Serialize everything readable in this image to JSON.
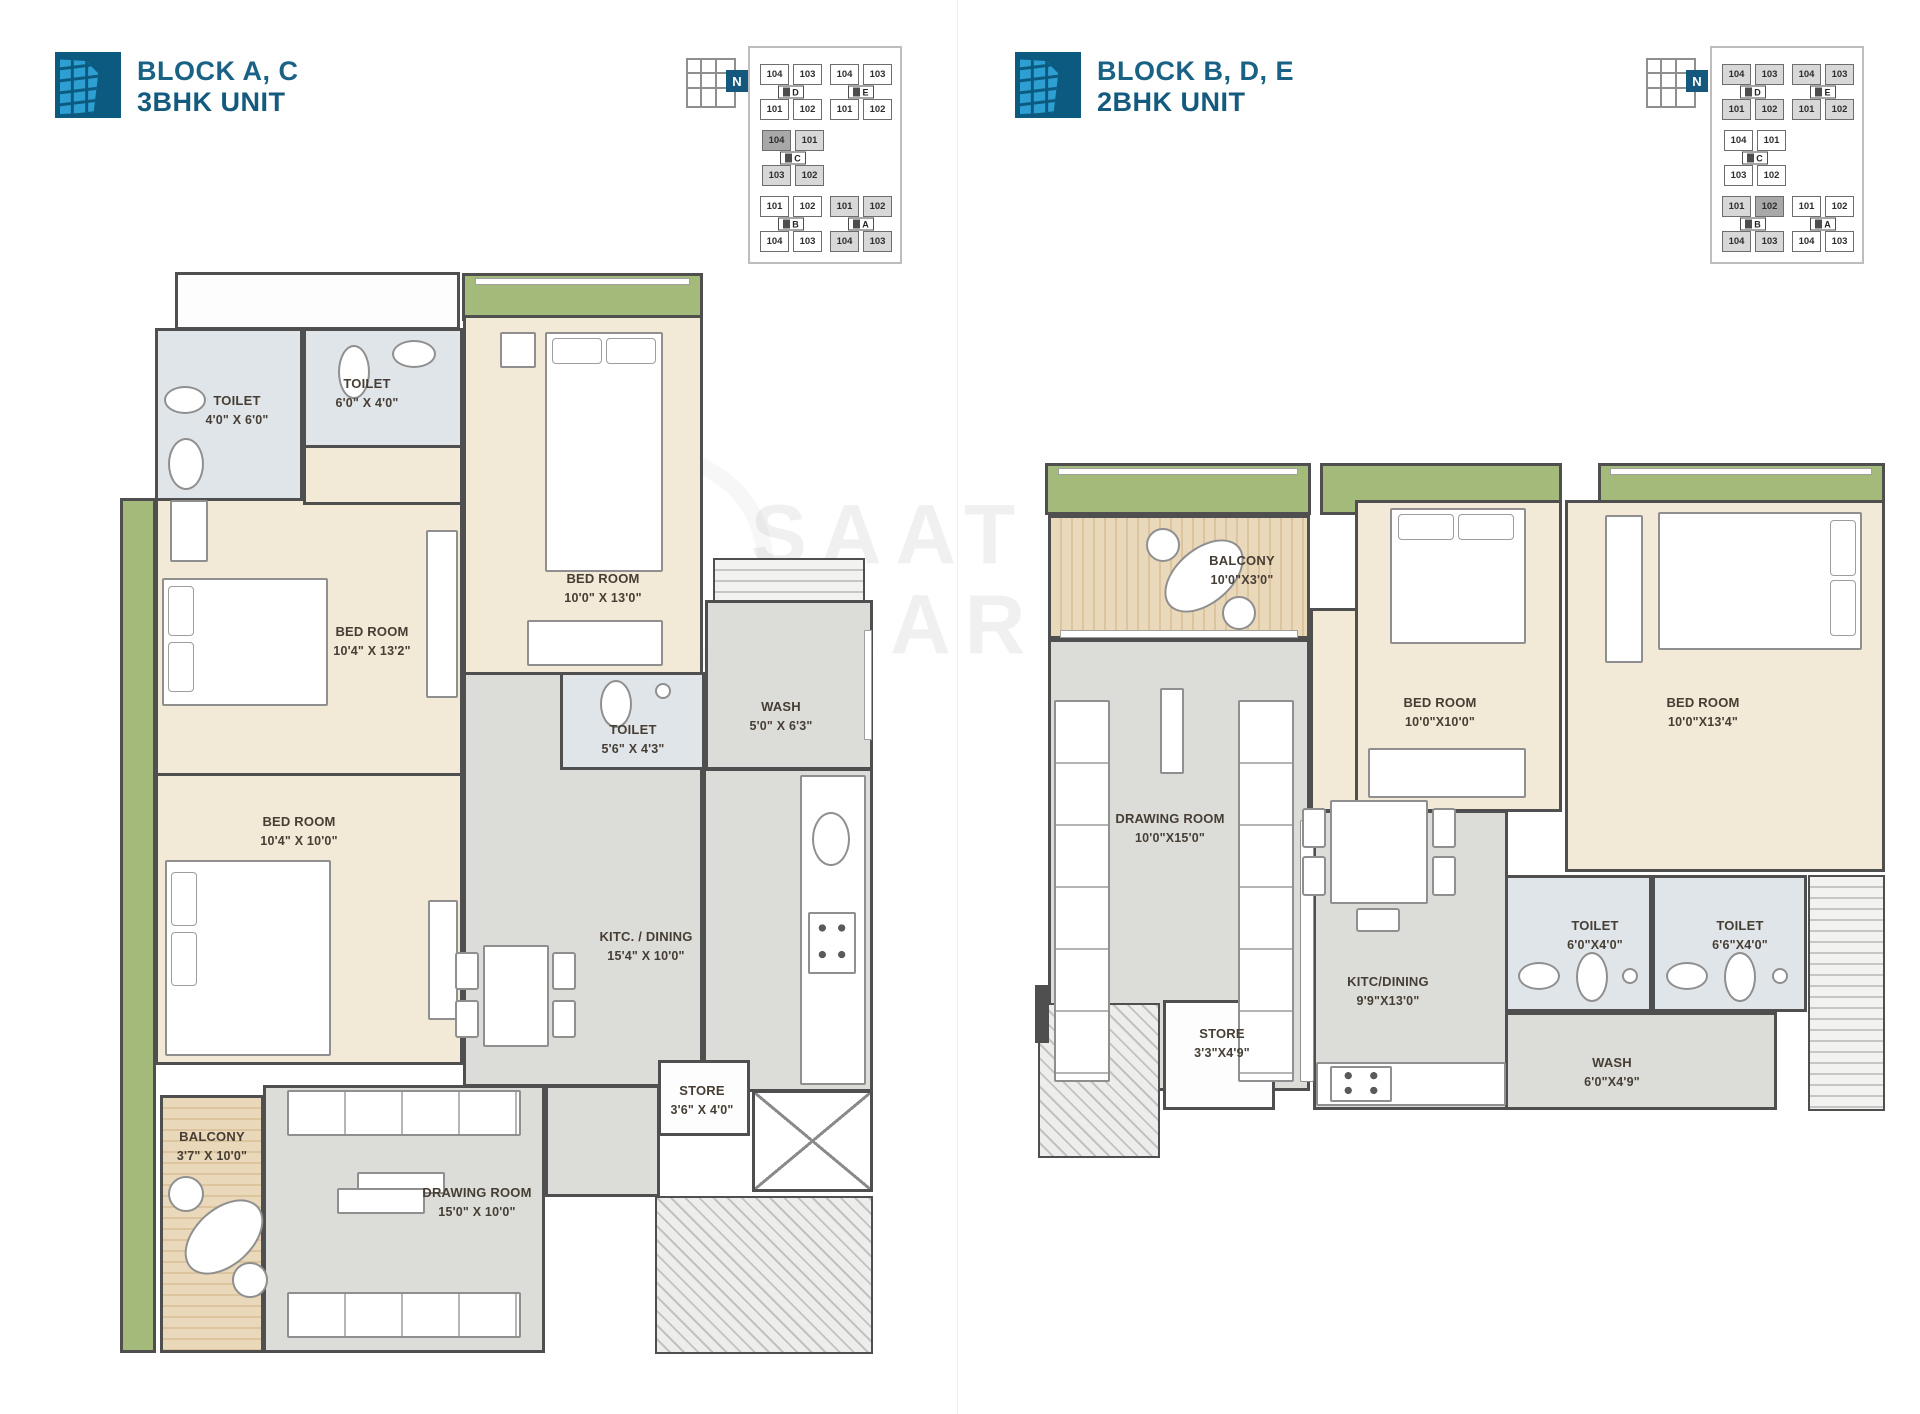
{
  "panels": {
    "left": {
      "block_title": "BLOCK A, C",
      "unit_title": "3BHK UNIT",
      "north": "N",
      "keyplan": {
        "highlighted_blocks": [
          "A",
          "C"
        ],
        "blocks": [
          {
            "letter": "D",
            "units": [
              "104",
              "103",
              "101",
              "102"
            ]
          },
          {
            "letter": "E",
            "units": [
              "104",
              "103",
              "101",
              "102"
            ]
          },
          {
            "letter": "C",
            "units": [
              "104",
              "101",
              "103",
              "102"
            ]
          },
          {
            "letter": "B",
            "units": [
              "101",
              "102",
              "104",
              "103"
            ]
          },
          {
            "letter": "A",
            "units": [
              "101",
              "102",
              "104",
              "103"
            ]
          }
        ]
      },
      "rooms": {
        "toilet1": {
          "name": "TOILET",
          "dim": "4'0\" X 6'0\""
        },
        "toilet2": {
          "name": "TOILET",
          "dim": "6'0\" X 4'0\""
        },
        "bedroom1": {
          "name": "BED ROOM",
          "dim": "10'0\" X 13'0\""
        },
        "bedroom2": {
          "name": "BED ROOM",
          "dim": "10'4\" X 13'2\""
        },
        "toilet3": {
          "name": "TOILET",
          "dim": "5'6\" X 4'3\""
        },
        "wash": {
          "name": "WASH",
          "dim": "5'0\" X 6'3\""
        },
        "bedroom3": {
          "name": "BED ROOM",
          "dim": "10'4\" X 10'0\""
        },
        "kitchen": {
          "name": "KITC. / DINING",
          "dim": "15'4\" X 10'0\""
        },
        "store": {
          "name": "STORE",
          "dim": "3'6\" X 4'0\""
        },
        "balcony": {
          "name": "BALCONY",
          "dim": "3'7\" X 10'0\""
        },
        "drawing": {
          "name": "DRAWING ROOM",
          "dim": "15'0\" X 10'0\""
        }
      }
    },
    "right": {
      "block_title": "BLOCK B, D, E",
      "unit_title": "2BHK UNIT",
      "north": "N",
      "keyplan": {
        "highlighted_blocks": [
          "B",
          "D",
          "E"
        ],
        "blocks": [
          {
            "letter": "D",
            "units": [
              "104",
              "103",
              "101",
              "102"
            ]
          },
          {
            "letter": "E",
            "units": [
              "104",
              "103",
              "101",
              "102"
            ]
          },
          {
            "letter": "C",
            "units": [
              "104",
              "101",
              "103",
              "102"
            ]
          },
          {
            "letter": "B",
            "units": [
              "101",
              "102",
              "104",
              "103"
            ]
          },
          {
            "letter": "A",
            "units": [
              "101",
              "102",
              "104",
              "103"
            ]
          }
        ]
      },
      "rooms": {
        "balcony": {
          "name": "BALCONY",
          "dim": "10'0\"X3'0\""
        },
        "bedroom1": {
          "name": "BED ROOM",
          "dim": "10'0\"X10'0\""
        },
        "bedroom2": {
          "name": "BED ROOM",
          "dim": "10'0\"X13'4\""
        },
        "drawing": {
          "name": "DRAWING ROOM",
          "dim": "10'0\"X15'0\""
        },
        "kitchen": {
          "name": "KITC/DINING",
          "dim": "9'9\"X13'0\""
        },
        "toilet1": {
          "name": "TOILET",
          "dim": "6'0\"X4'0\""
        },
        "toilet2": {
          "name": "TOILET",
          "dim": "6'6\"X4'0\""
        },
        "store": {
          "name": "STORE",
          "dim": "3'3\"X4'9\""
        },
        "wash": {
          "name": "WASH",
          "dim": "6'0\"X4'9\""
        }
      }
    }
  },
  "watermark": {
    "line1": "SAAT",
    "line2": "BAAR"
  },
  "colors": {
    "accent": "#1a6285",
    "wall": "#4f4f4f",
    "green": "#a3ba7b",
    "beige": "#f3e9d7"
  }
}
